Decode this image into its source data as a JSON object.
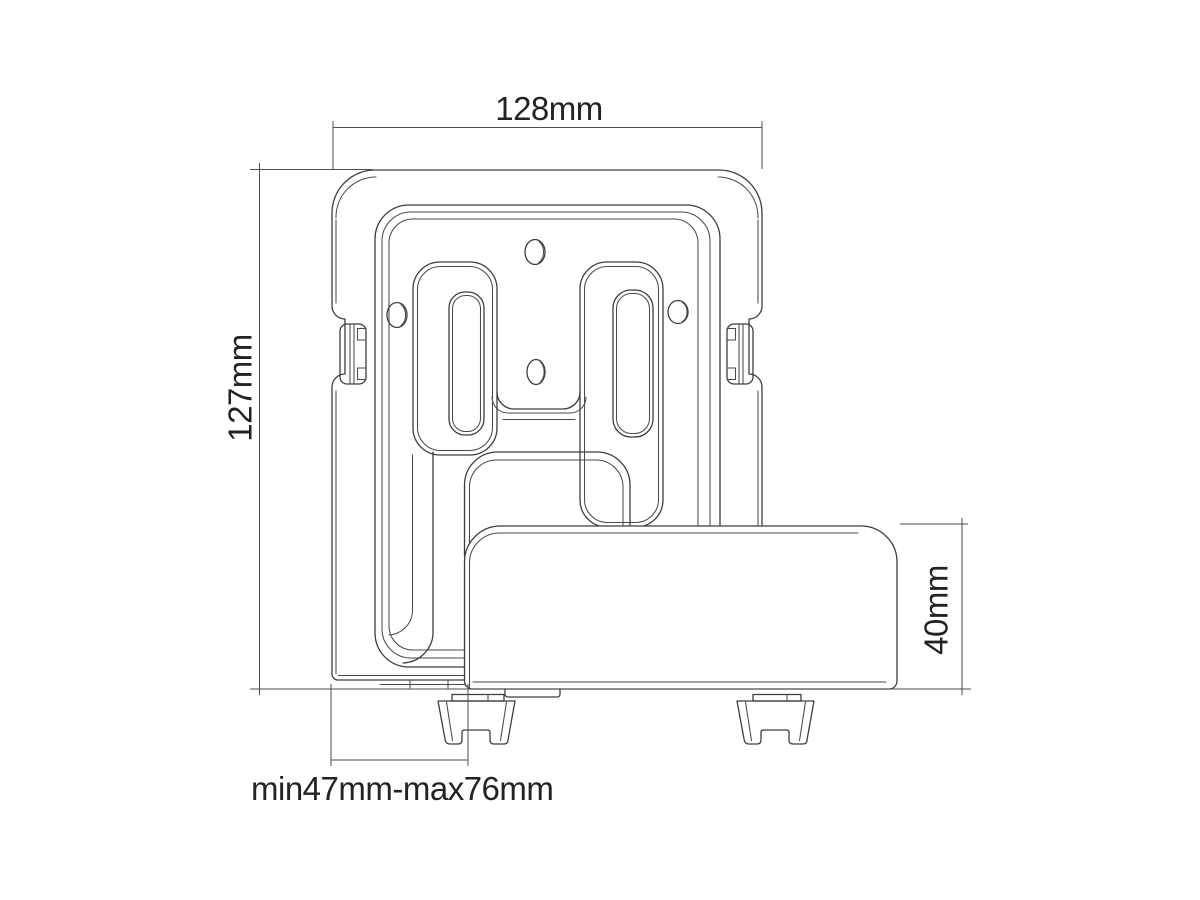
{
  "figure": {
    "background": "#ffffff",
    "line_color": "#3d3d3d",
    "dimension_line_color": "#4d4d4d",
    "text_color": "#232323"
  },
  "dimensions": {
    "top_width": "128mm",
    "left_height": "127mm",
    "right_depth": "40mm",
    "bottom_range": "min47mm-max76mm"
  }
}
